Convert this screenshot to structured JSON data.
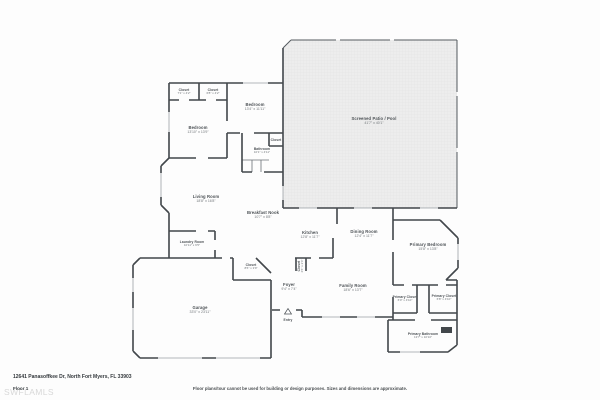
{
  "meta": {
    "address": "12641 Panasoffkee Dr, North Fort Myers, FL 33903",
    "floor": "Floor 1",
    "watermark": "SWFLAMLS",
    "disclaimer": "Floor plans/tour cannot be used for building or design purposes. Sizes and dimensions are approximate."
  },
  "colors": {
    "wall": "#42474b",
    "window": "#9ba1a6",
    "screen": "#555b60",
    "patio_fill": "#ededed",
    "patio_grid": "#e0e0e0",
    "text": "#4d5256",
    "dims_text": "#73787c",
    "watermark": "#d8d8d8"
  },
  "rooms": {
    "closet_a": {
      "name": "Closet",
      "dims": "7'1\" x 4'2\""
    },
    "closet_b": {
      "name": "Closet",
      "dims": "6'8\" x 4'2\""
    },
    "bedroom_a": {
      "name": "Bedroom",
      "dims": "13'4\" x 11'11\""
    },
    "bedroom_b": {
      "name": "Bedroom",
      "dims": "13'10\" x 13'9\""
    },
    "bathroom": {
      "name": "Bathroom",
      "dims": "10'1\" x 4'11\""
    },
    "closet_c": {
      "name": "Closet"
    },
    "patio": {
      "name": "Screened Patio / Pool",
      "dims": "41'7\" x 40'1\""
    },
    "living": {
      "name": "Living Room",
      "dims": "18'8\" x 16'8\""
    },
    "nook": {
      "name": "Breakfast Nook",
      "dims": "10'7\" x 8'8\""
    },
    "kitchen": {
      "name": "Kitchen",
      "dims": "12'8\" x 11'7\""
    },
    "dining": {
      "name": "Dining Room",
      "dims": "12'4\" x 11'7\""
    },
    "laundry": {
      "name": "Laundry Room",
      "dims": "10'11\" x 6'5\""
    },
    "closet_d": {
      "name": "Closet",
      "dims": "8'6\" x 3'9\""
    },
    "foyer": {
      "name": "Foyer",
      "dims": "9'4\" x 7'4\""
    },
    "closet_e": {
      "name": "Closet",
      "dims": "4'6\" x 2'4\""
    },
    "family": {
      "name": "Family Room",
      "dims": "18'6\" x 13'7\""
    },
    "primary_bedroom": {
      "name": "Primary Bedroom",
      "dims": "15'8\" x 13'8\""
    },
    "primary_closet_a": {
      "name": "Primary Closet",
      "dims": "6'0\" x 4'10\""
    },
    "primary_closet_b": {
      "name": "Primary Closet",
      "dims": "6'8\" x 4'10\""
    },
    "primary_bath": {
      "name": "Primary Bathroom",
      "dims": "13'7\" x 10'10\""
    },
    "garage": {
      "name": "Garage",
      "dims": "33'0\" x 23'11\""
    },
    "entry": {
      "name": "Entry"
    }
  }
}
